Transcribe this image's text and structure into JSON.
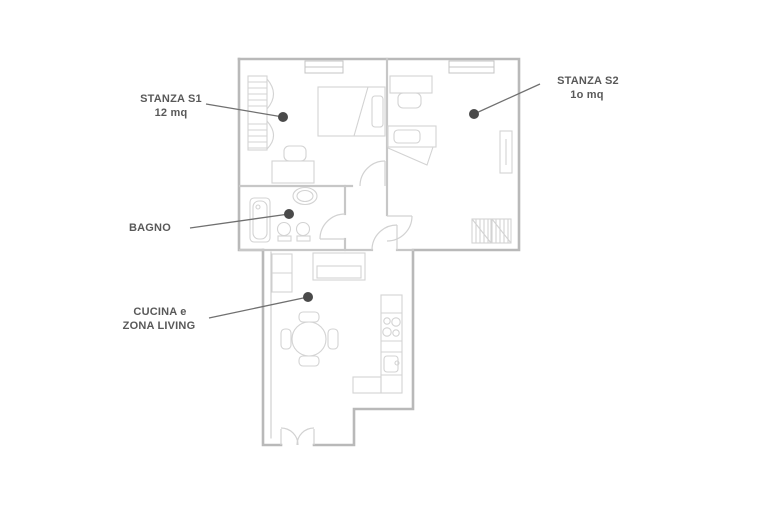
{
  "title": "Apartment floor plan",
  "colors": {
    "background": "#ffffff",
    "wall": "#b9b9b9",
    "inner_wall": "#c7c7c7",
    "furniture": "#d3d3d3",
    "door_arc": "#d2d2d2",
    "label_text": "#595959",
    "leader_line": "#707070",
    "marker_dot": "#4a4a4a"
  },
  "rooms": [
    {
      "id": "stanza-s1",
      "label_line1": "STANZA S1",
      "label_line2": "12 mq"
    },
    {
      "id": "stanza-s2",
      "label_line1": "STANZA S2",
      "label_line2": "1o mq"
    },
    {
      "id": "bagno",
      "label_line1": "BAGNO",
      "label_line2": ""
    },
    {
      "id": "cucina-zona-living",
      "label_line1": "CUCINA e",
      "label_line2": "ZONA LIVING"
    }
  ]
}
